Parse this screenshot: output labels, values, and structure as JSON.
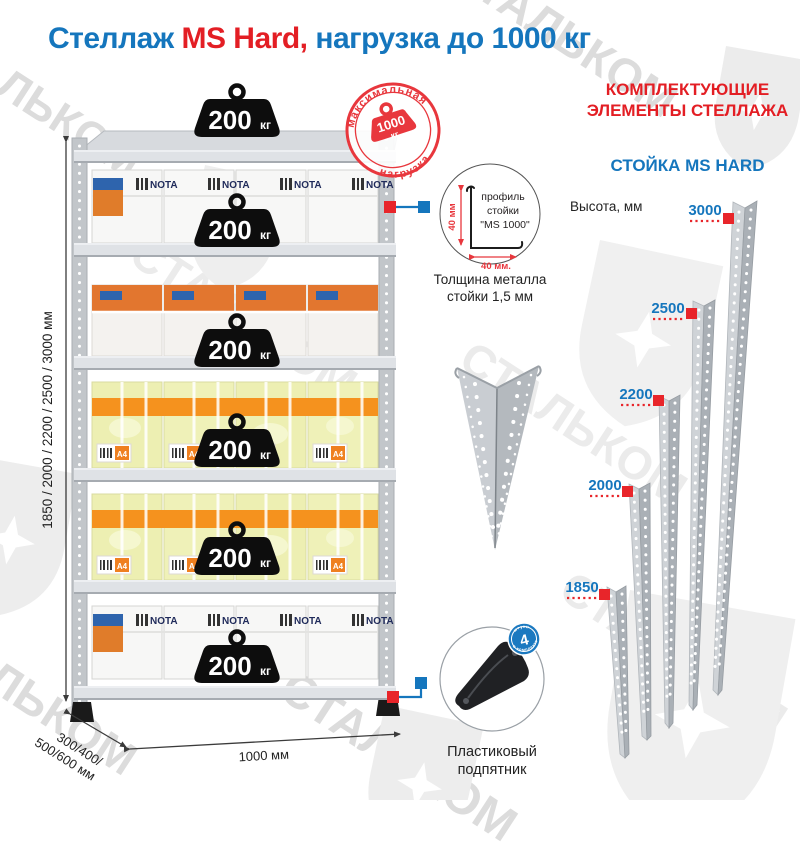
{
  "title": {
    "part1": "Стеллаж ",
    "part2": "MS Hard,",
    "part3": " нагрузка до 1000 кг"
  },
  "watermark": {
    "text": "СТАЛЬКОМ"
  },
  "stamp": {
    "arc_top": "максимальная",
    "arc_bottom": "нагрузка",
    "value": "1000",
    "unit": "кг"
  },
  "rack": {
    "shelf_load": "200",
    "shelf_load_unit": "кг",
    "height_label": "1850 / 2000 / 2200 / 2500 / 3000 мм",
    "depth_label_line1": "300/400/",
    "depth_label_line2": "500/600 мм",
    "width_label": "1000 мм",
    "box_brand": "NOTA",
    "box_size": "A4"
  },
  "profile": {
    "dim_vertical": "40 мм",
    "dim_horizontal": "40 мм.",
    "label_line1": "профиль",
    "label_line2": "стойки",
    "label_line3": "\"MS 1000\"",
    "thickness_line1": "Толщина металла",
    "thickness_line2": "стойки 1,5 мм"
  },
  "foot": {
    "badge_value": "4",
    "badge_word1": "штуки",
    "badge_word2": "в комплекте",
    "label_line1": "Пластиковый",
    "label_line2": "подпятник"
  },
  "components": {
    "header_line1": "КОМПЛЕКТУЮЩИЕ",
    "header_line2": "ЭЛЕМЕНТЫ СТЕЛЛАЖА",
    "subheader": "СТОЙКА MS HARD",
    "height_caption": "Высота, мм",
    "posts": [
      {
        "height": "3000"
      },
      {
        "height": "2500"
      },
      {
        "height": "2200"
      },
      {
        "height": "2000"
      },
      {
        "height": "1850"
      }
    ]
  },
  "colors": {
    "accent_blue": "#1576bd",
    "accent_red": "#e31e24",
    "stamp_red": "#e8373d",
    "text_black": "#231f20",
    "steel_light": "#d4d7da",
    "steel_dark": "#aab0b6"
  }
}
